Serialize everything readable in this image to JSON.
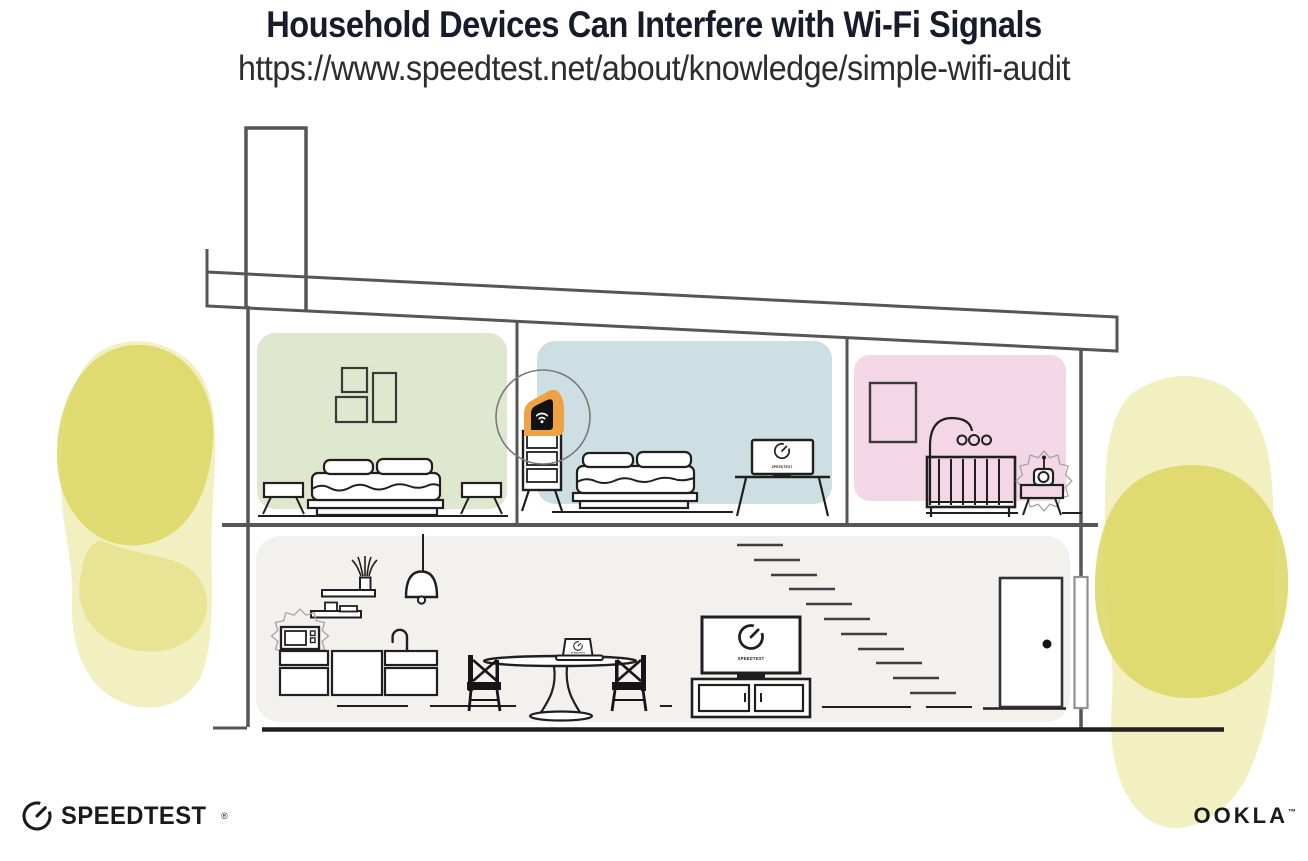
{
  "header": {
    "title": "Household Devices Can Interfere with Wi-Fi Signals",
    "url": "https://www.speedtest.net/about/knowledge/simple-wifi-audit"
  },
  "footer": {
    "speedtest_wordmark": "SPEEDTEST",
    "speedtest_trademark": "®",
    "ookla_wordmark": "OOKLA",
    "ookla_trademark": "™"
  },
  "illustration": {
    "screen_labels": {
      "bedroom_monitor": "SPEEDTEST",
      "living_room_tv": "SPEEDTEST",
      "dining_laptop": "SPEEDTEST"
    },
    "icons": {
      "router": "wifi-icon",
      "speedtest_logo": "gauge-icon",
      "interference": "burst-icon"
    },
    "colors": {
      "title_color": "#171c2b",
      "url_color": "#2d2d31",
      "room_green": "#dfe8ce",
      "room_blue": "#cddfe2",
      "room_pink": "#f4d7e6",
      "room_gray": "#f2f1ee",
      "highlight_orange": "#efa243",
      "foliage_core": "#dbd55e",
      "foliage_wash": "#efecb0",
      "line_structure": "#55555a",
      "line_furniture": "#1f1f1f",
      "router_black": "#121212",
      "logo_black": "#1a1a1a"
    }
  }
}
